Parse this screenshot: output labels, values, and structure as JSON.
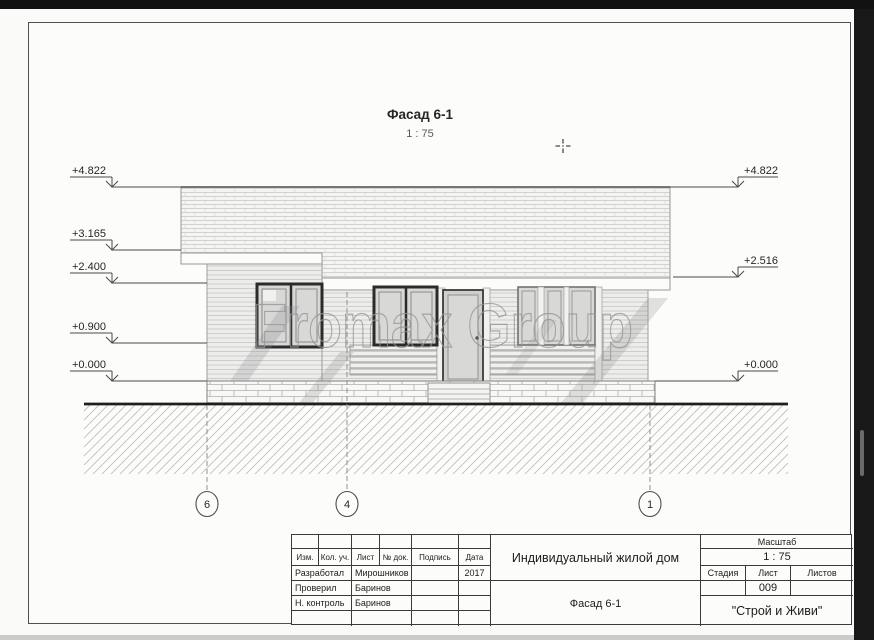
{
  "sheet": {
    "title": "Фасад 6-1",
    "scale": "1 : 75"
  },
  "watermark": "Fromax Group",
  "levels_left": [
    {
      "value": "+4.822"
    },
    {
      "value": "+3.165"
    },
    {
      "value": "+2.400"
    },
    {
      "value": "+0.900"
    },
    {
      "value": "+0.000"
    }
  ],
  "levels_right": [
    {
      "value": "+4.822"
    },
    {
      "value": "+2.516"
    },
    {
      "value": "+0.000"
    }
  ],
  "axes": [
    {
      "label": "6"
    },
    {
      "label": "4"
    },
    {
      "label": "1"
    }
  ],
  "titleblock": {
    "columns": [
      "Изм.",
      "Кол. уч.",
      "Лист",
      "№ док.",
      "Подпись",
      "Дата"
    ],
    "rows": [
      {
        "role": "Разработал",
        "name": "Мирошников",
        "sign": "",
        "date": "2017"
      },
      {
        "role": "Проверил",
        "name": "Баринов",
        "sign": "",
        "date": ""
      },
      {
        "role": "Н. контроль",
        "name": "Баринов",
        "sign": "",
        "date": ""
      }
    ],
    "project": "Индивидуальный жилой дом",
    "drawing": "Фасад 6-1",
    "scale_label": "Масштаб",
    "scale_value": "1 : 75",
    "stage_label": "Стадия",
    "sheet_label": "Лист",
    "sheets_label": "Листов",
    "sheet_value": "009",
    "company": "\"Строй и Живи\""
  },
  "colors": {
    "paper": "#fcfcfb",
    "chrome": "#141414",
    "line": "#3a3a3a",
    "watermark_stroke": "#979796"
  }
}
